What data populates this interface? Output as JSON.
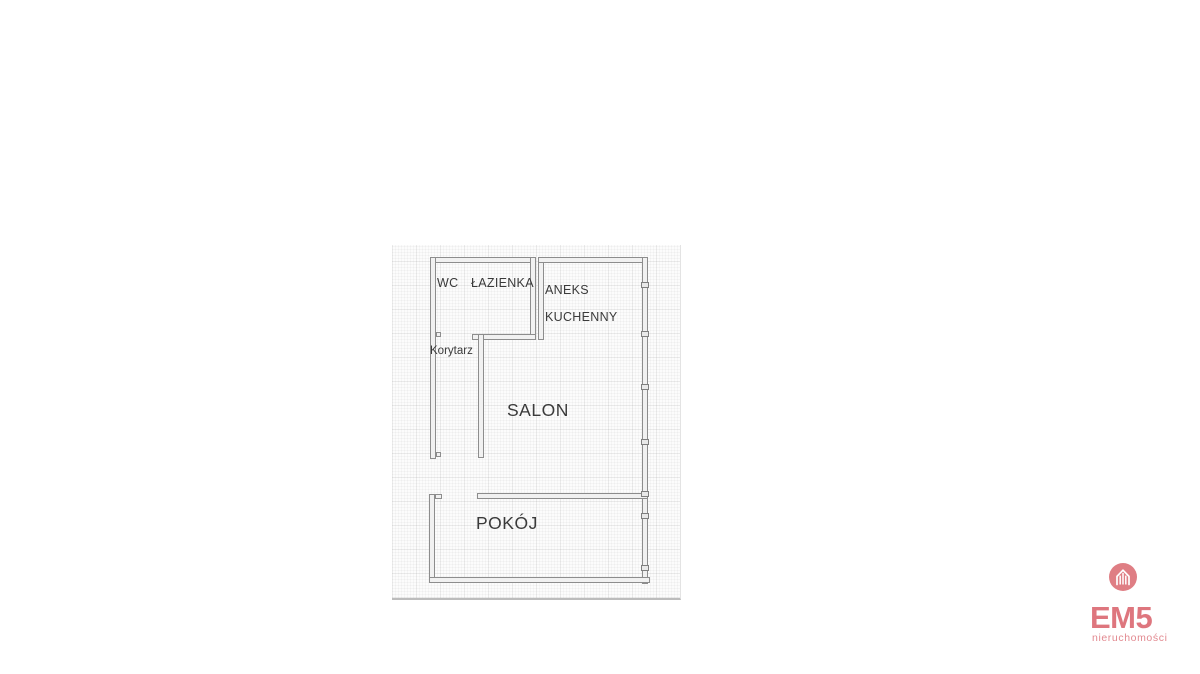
{
  "floor_plan": {
    "labels": {
      "wc": "WC",
      "lazienka": "ŁAZIENKA",
      "aneks_line1": "ANEKS",
      "aneks_line2": "KUCHENNY",
      "korytarz": "Korytarz",
      "salon": "SALON",
      "pokoj": "POKÓJ"
    },
    "colors": {
      "wall_outline": "#8d8d8d",
      "wall_fill": "#f1f1f1",
      "label_text": "#3a3a3a",
      "paper_background": "#fcfcfc"
    }
  },
  "logo": {
    "name": "EM5",
    "subtitle": "nieruchomości",
    "brand_color": "#de767e",
    "icon": "house-buildings-icon"
  }
}
